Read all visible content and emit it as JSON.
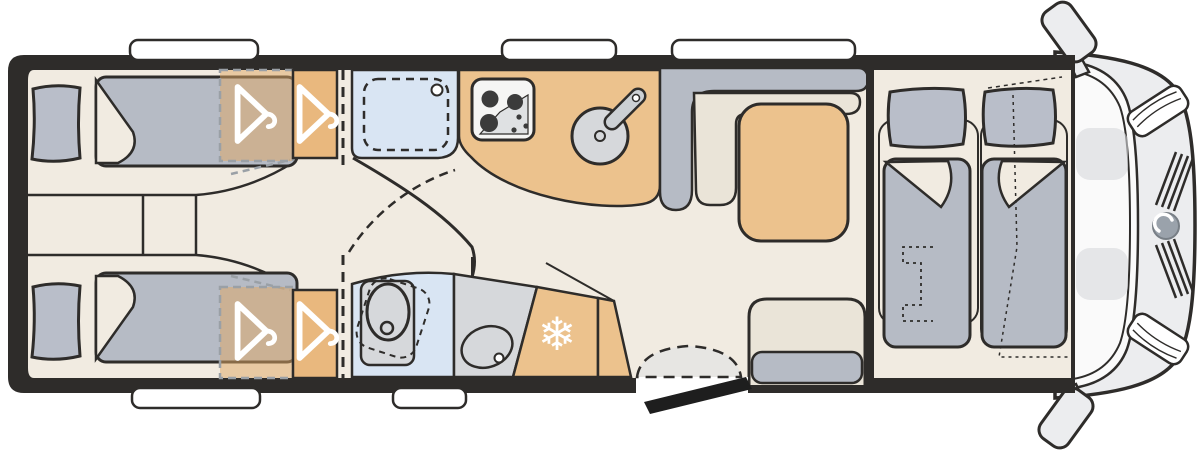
{
  "diagram": {
    "kind": "motorhome-floorplan-top-view",
    "rooms": {
      "rear_bedroom": "twin-single-beds",
      "washroom": "shower-and-swivel-toilet",
      "kitchen": "hob-and-sink",
      "lounge": "l-bench-dinette-with-table",
      "front": "drop-down-bed-over-cab-seats"
    }
  },
  "icons": {
    "snowflake_glyph": "❄",
    "snowflake_icon": "fridge-freezer-snowflake",
    "hanger_icon": "clothes-hanger",
    "mirror_icon": "side-mirror",
    "logo_icon": "brand-emblem"
  },
  "colors": {
    "outline": "#2e2c2a",
    "wall": "#2e2c2a",
    "floor": "#f1ebe1",
    "bedding": "#b6bbc5",
    "pillow": "#b9bec9",
    "wood": "#ecc28d",
    "wardrobe": "#e9b87e",
    "wardrobe_overlay": "rgba(223,167,100,0.5)",
    "shower": "#d9e5f3",
    "counter": "#d6d8db",
    "seat": "#eae4d8",
    "cushion": "#b6bbc5",
    "appliance": "#f5f5f4",
    "hob_inner": "#dfe1e3",
    "stepgray": "#e7e6e3",
    "cab_body": "#ecedef",
    "glass": "#fafafa",
    "faint": "#d7d9dc",
    "logo": "#9aa2ab",
    "burner": "#3b3b3b",
    "dash_gray": "#9aa0a6",
    "door_dark": "#1e1e1e",
    "tap": "#ccd0d4"
  }
}
